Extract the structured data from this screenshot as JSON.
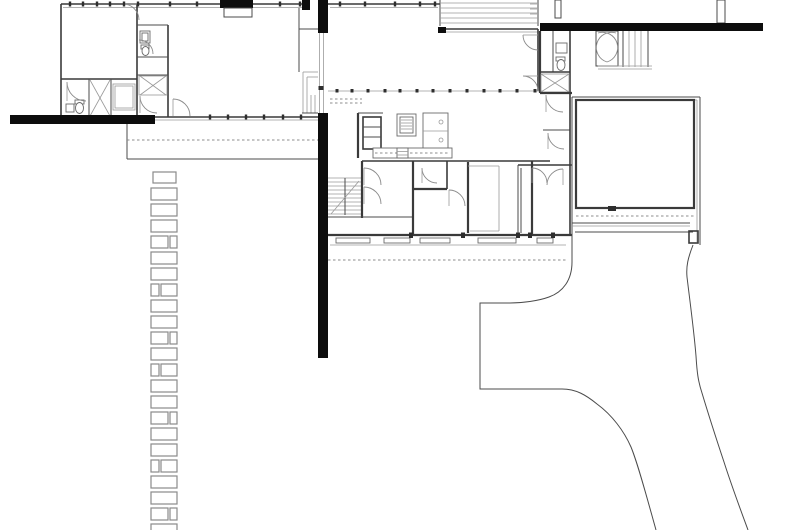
{
  "meta": {
    "title": "House floor plan with garden path and driveway",
    "drawing_type": "architectural-floor-plan",
    "visible_text": "none"
  },
  "colors": {
    "background": "#ffffff",
    "line": "#4b4b4b",
    "wall": "#3a3a3a",
    "poche_black": "#0d0d0d",
    "light_gray": "#9a9a9a",
    "dashed_gray": "#8c8c8c"
  },
  "site": {
    "stepping_stones": {
      "x": 151,
      "width": 26,
      "start_y": 172,
      "period": 16,
      "stone_height": 12,
      "pattern": [
        "full",
        "full",
        "full",
        "split-r",
        "full",
        "full",
        "split-l",
        "full",
        "full",
        "split-r",
        "full",
        "split-l",
        "full",
        "full",
        "split-r",
        "full",
        "full",
        "split-l",
        "full",
        "full",
        "split-r",
        "full",
        "split-l"
      ]
    },
    "mullions": [
      {
        "name": "north-wall-ticks",
        "y": 1.5,
        "h": 5,
        "w": 2.4,
        "xs": [
          70,
          83,
          97,
          110,
          124,
          138,
          170,
          197,
          280,
          300,
          340,
          365,
          395,
          420,
          435
        ]
      },
      {
        "name": "west-south-glass-ticks",
        "y": 114.5,
        "h": 5,
        "w": 2.4,
        "xs": [
          210,
          228,
          246,
          264,
          283,
          301
        ]
      },
      {
        "name": "gallery-glass-ticks",
        "y": 89,
        "h": 3.5,
        "w": 3,
        "xs": [
          337,
          352,
          368,
          385,
          400,
          417,
          433,
          450,
          467,
          484,
          500,
          517,
          535
        ]
      },
      {
        "name": "south-facade-piers",
        "y": 232.5,
        "h": 5.5,
        "w": 4,
        "xs": [
          411,
          463,
          518,
          530,
          553
        ]
      }
    ]
  }
}
